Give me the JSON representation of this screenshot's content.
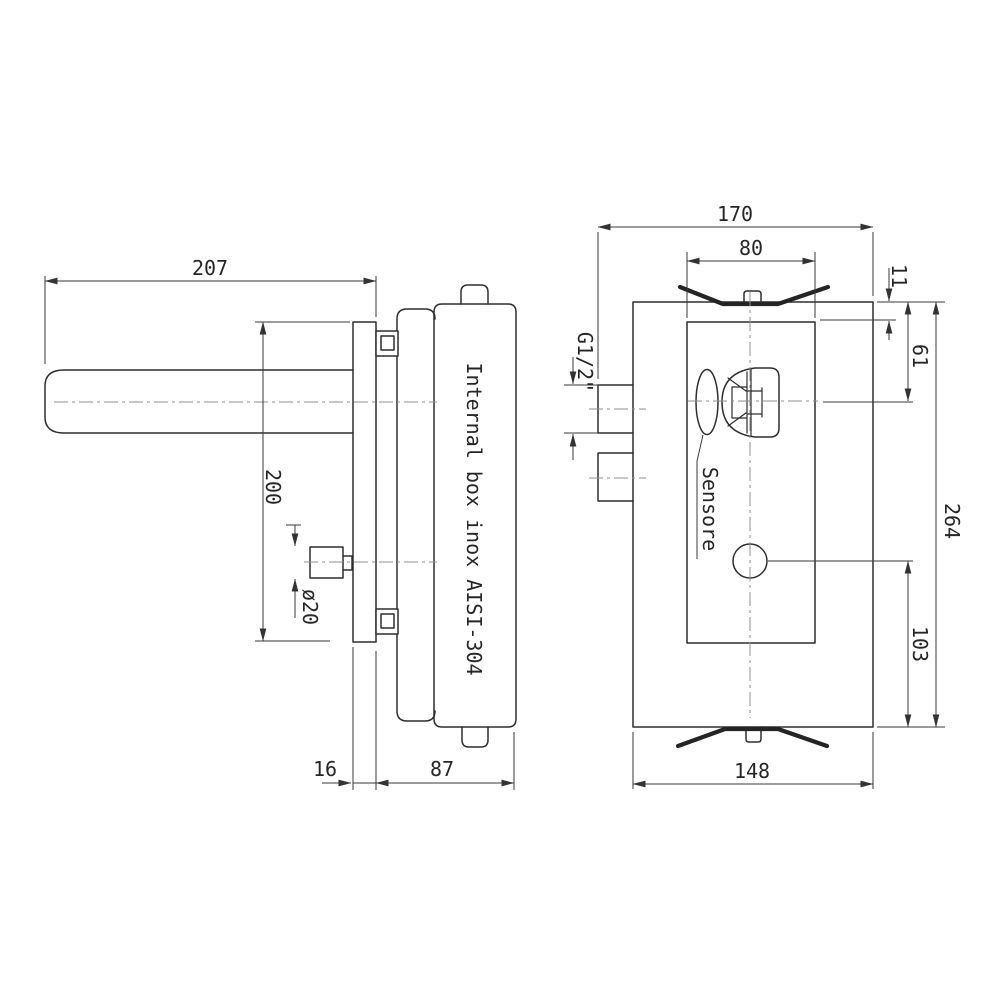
{
  "side_view": {
    "box_label": "Internal box inox AISI-304",
    "dims": {
      "spout_length": "207",
      "plate_height": "200",
      "knob_diameter": "ø20",
      "wall_plate_thickness": "16",
      "box_depth": "87"
    }
  },
  "front_view": {
    "dims": {
      "overall_width_with_inlets": "170",
      "inner_box_width": "80",
      "inner_box_top_offset": "11",
      "spout_axis_from_top": "61",
      "overall_height": "264",
      "hole_from_bottom": "103",
      "body_width": "148"
    },
    "thread_label": "G1/2\"",
    "sensor_label": "Sensore"
  }
}
